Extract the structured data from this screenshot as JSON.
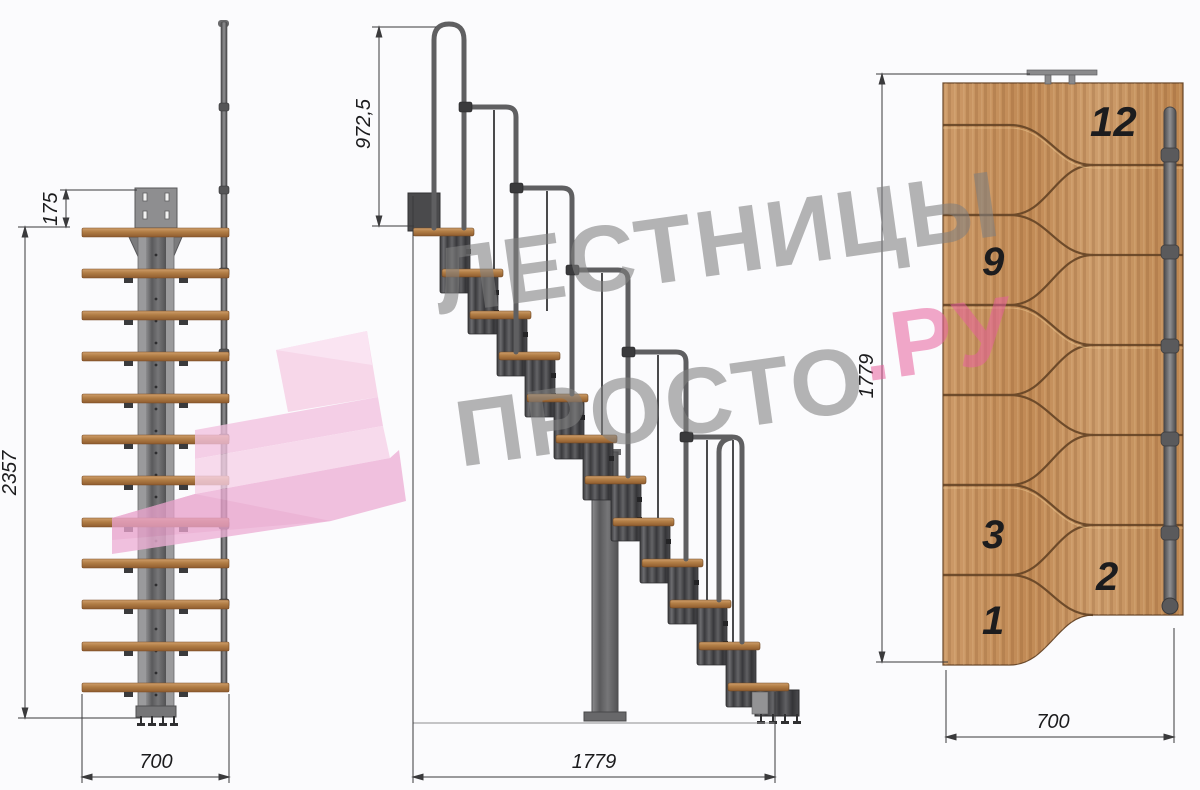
{
  "watermark": {
    "line1": "ЛЕСТНИЦЫ",
    "line2_gray": "ПРОСТО",
    "line2_pink": ".РУ"
  },
  "views": {
    "front": {
      "title": "front elevation of modular staircase",
      "dims": {
        "offset": "175",
        "height": "2357",
        "width": "700"
      }
    },
    "side": {
      "title": "side elevation of modular staircase",
      "dims": {
        "rail_height": "972,5",
        "length": "1779"
      }
    },
    "plan": {
      "title": "top plan view of staircase",
      "dims": {
        "length": "1779",
        "width": "700"
      },
      "step_labels": [
        "12",
        "9",
        "3",
        "2",
        "1"
      ]
    }
  },
  "colors": {
    "wood": "#c08a58",
    "steel_dark": "#3f3f41",
    "steel_light": "#98989a",
    "brand_pink": "#e7609d",
    "watermark_gray": "#808080",
    "dimension": "#1b1b1d"
  }
}
